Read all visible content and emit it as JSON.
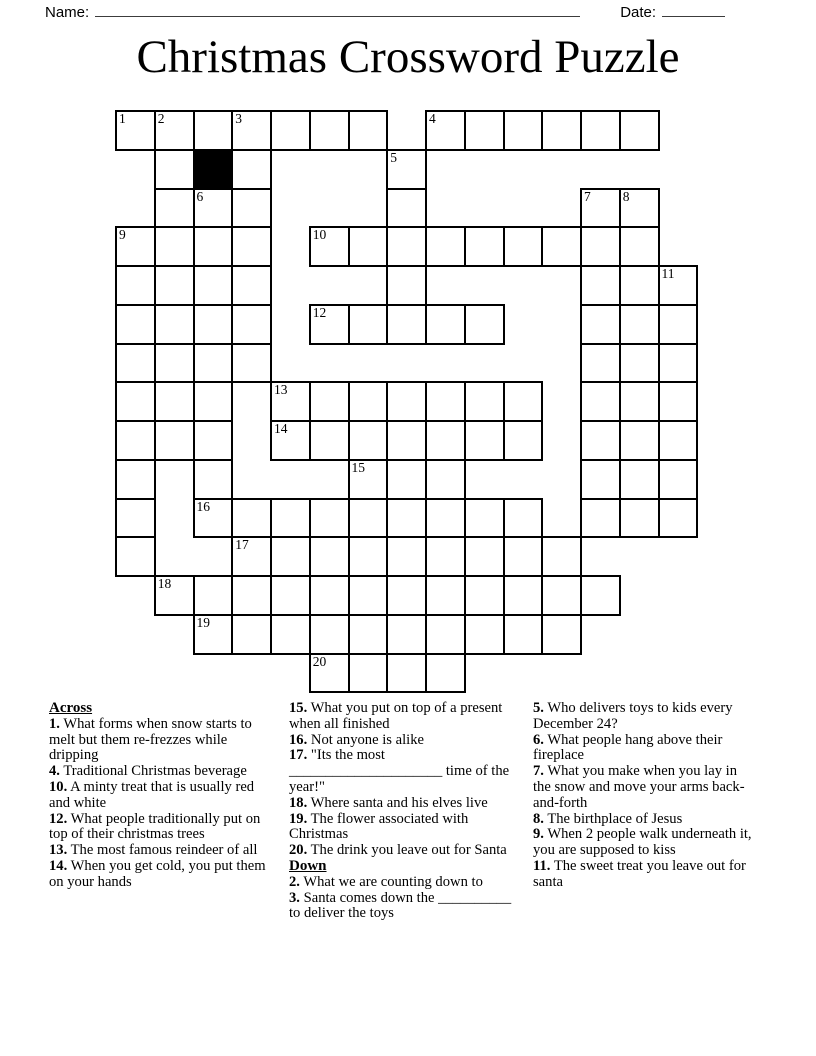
{
  "header": {
    "name_label": "Name:",
    "date_label": "Date:"
  },
  "title": "Christmas Crossword Puzzle",
  "grid": {
    "origin_x": 115,
    "origin_y": 110,
    "cell_size": 38.75,
    "rows": 15,
    "cols": 15,
    "border_color": "#000000",
    "block_color": "#000000",
    "cells": [
      {
        "r": 0,
        "c": 0,
        "n": "1"
      },
      {
        "r": 0,
        "c": 1,
        "n": "2"
      },
      {
        "r": 0,
        "c": 2
      },
      {
        "r": 0,
        "c": 3,
        "n": "3"
      },
      {
        "r": 0,
        "c": 4
      },
      {
        "r": 0,
        "c": 5
      },
      {
        "r": 0,
        "c": 6
      },
      {
        "r": 0,
        "c": 8,
        "n": "4"
      },
      {
        "r": 0,
        "c": 9
      },
      {
        "r": 0,
        "c": 10
      },
      {
        "r": 0,
        "c": 11
      },
      {
        "r": 0,
        "c": 12
      },
      {
        "r": 0,
        "c": 13
      },
      {
        "r": 1,
        "c": 1
      },
      {
        "r": 1,
        "c": 2,
        "b": true
      },
      {
        "r": 1,
        "c": 3
      },
      {
        "r": 1,
        "c": 7,
        "n": "5"
      },
      {
        "r": 2,
        "c": 1
      },
      {
        "r": 2,
        "c": 2,
        "n": "6"
      },
      {
        "r": 2,
        "c": 3
      },
      {
        "r": 2,
        "c": 7
      },
      {
        "r": 2,
        "c": 12,
        "n": "7"
      },
      {
        "r": 2,
        "c": 13,
        "n": "8"
      },
      {
        "r": 3,
        "c": 0,
        "n": "9"
      },
      {
        "r": 3,
        "c": 1
      },
      {
        "r": 3,
        "c": 2
      },
      {
        "r": 3,
        "c": 3
      },
      {
        "r": 3,
        "c": 5,
        "n": "10"
      },
      {
        "r": 3,
        "c": 6
      },
      {
        "r": 3,
        "c": 7
      },
      {
        "r": 3,
        "c": 8
      },
      {
        "r": 3,
        "c": 9
      },
      {
        "r": 3,
        "c": 10
      },
      {
        "r": 3,
        "c": 11
      },
      {
        "r": 3,
        "c": 12
      },
      {
        "r": 3,
        "c": 13
      },
      {
        "r": 4,
        "c": 0
      },
      {
        "r": 4,
        "c": 1
      },
      {
        "r": 4,
        "c": 2
      },
      {
        "r": 4,
        "c": 3
      },
      {
        "r": 4,
        "c": 7
      },
      {
        "r": 4,
        "c": 12
      },
      {
        "r": 4,
        "c": 13
      },
      {
        "r": 4,
        "c": 14,
        "n": "11"
      },
      {
        "r": 5,
        "c": 0
      },
      {
        "r": 5,
        "c": 1
      },
      {
        "r": 5,
        "c": 2
      },
      {
        "r": 5,
        "c": 3
      },
      {
        "r": 5,
        "c": 5,
        "n": "12"
      },
      {
        "r": 5,
        "c": 6
      },
      {
        "r": 5,
        "c": 7
      },
      {
        "r": 5,
        "c": 8
      },
      {
        "r": 5,
        "c": 9
      },
      {
        "r": 5,
        "c": 12
      },
      {
        "r": 5,
        "c": 13
      },
      {
        "r": 5,
        "c": 14
      },
      {
        "r": 6,
        "c": 0
      },
      {
        "r": 6,
        "c": 1
      },
      {
        "r": 6,
        "c": 2
      },
      {
        "r": 6,
        "c": 3
      },
      {
        "r": 6,
        "c": 12
      },
      {
        "r": 6,
        "c": 13
      },
      {
        "r": 6,
        "c": 14
      },
      {
        "r": 7,
        "c": 0
      },
      {
        "r": 7,
        "c": 1
      },
      {
        "r": 7,
        "c": 2
      },
      {
        "r": 7,
        "c": 4,
        "n": "13"
      },
      {
        "r": 7,
        "c": 5
      },
      {
        "r": 7,
        "c": 6
      },
      {
        "r": 7,
        "c": 7
      },
      {
        "r": 7,
        "c": 8
      },
      {
        "r": 7,
        "c": 9
      },
      {
        "r": 7,
        "c": 10
      },
      {
        "r": 7,
        "c": 12
      },
      {
        "r": 7,
        "c": 13
      },
      {
        "r": 7,
        "c": 14
      },
      {
        "r": 8,
        "c": 0
      },
      {
        "r": 8,
        "c": 1
      },
      {
        "r": 8,
        "c": 2
      },
      {
        "r": 8,
        "c": 4,
        "n": "14"
      },
      {
        "r": 8,
        "c": 5
      },
      {
        "r": 8,
        "c": 6
      },
      {
        "r": 8,
        "c": 7
      },
      {
        "r": 8,
        "c": 8
      },
      {
        "r": 8,
        "c": 9
      },
      {
        "r": 8,
        "c": 10
      },
      {
        "r": 8,
        "c": 12
      },
      {
        "r": 8,
        "c": 13
      },
      {
        "r": 8,
        "c": 14
      },
      {
        "r": 9,
        "c": 0
      },
      {
        "r": 9,
        "c": 2
      },
      {
        "r": 9,
        "c": 6,
        "n": "15"
      },
      {
        "r": 9,
        "c": 7
      },
      {
        "r": 9,
        "c": 8
      },
      {
        "r": 9,
        "c": 12
      },
      {
        "r": 9,
        "c": 13
      },
      {
        "r": 9,
        "c": 14
      },
      {
        "r": 10,
        "c": 0
      },
      {
        "r": 10,
        "c": 2,
        "n": "16"
      },
      {
        "r": 10,
        "c": 3
      },
      {
        "r": 10,
        "c": 4
      },
      {
        "r": 10,
        "c": 5
      },
      {
        "r": 10,
        "c": 6
      },
      {
        "r": 10,
        "c": 7
      },
      {
        "r": 10,
        "c": 8
      },
      {
        "r": 10,
        "c": 9
      },
      {
        "r": 10,
        "c": 10
      },
      {
        "r": 10,
        "c": 12
      },
      {
        "r": 10,
        "c": 13
      },
      {
        "r": 10,
        "c": 14
      },
      {
        "r": 11,
        "c": 0
      },
      {
        "r": 11,
        "c": 3,
        "n": "17"
      },
      {
        "r": 11,
        "c": 4
      },
      {
        "r": 11,
        "c": 5
      },
      {
        "r": 11,
        "c": 6
      },
      {
        "r": 11,
        "c": 7
      },
      {
        "r": 11,
        "c": 8
      },
      {
        "r": 11,
        "c": 9
      },
      {
        "r": 11,
        "c": 10
      },
      {
        "r": 11,
        "c": 11
      },
      {
        "r": 12,
        "c": 1,
        "n": "18"
      },
      {
        "r": 12,
        "c": 2
      },
      {
        "r": 12,
        "c": 3
      },
      {
        "r": 12,
        "c": 4
      },
      {
        "r": 12,
        "c": 5
      },
      {
        "r": 12,
        "c": 6
      },
      {
        "r": 12,
        "c": 7
      },
      {
        "r": 12,
        "c": 8
      },
      {
        "r": 12,
        "c": 9
      },
      {
        "r": 12,
        "c": 10
      },
      {
        "r": 12,
        "c": 11
      },
      {
        "r": 12,
        "c": 12
      },
      {
        "r": 13,
        "c": 2,
        "n": "19"
      },
      {
        "r": 13,
        "c": 3
      },
      {
        "r": 13,
        "c": 4
      },
      {
        "r": 13,
        "c": 5
      },
      {
        "r": 13,
        "c": 6
      },
      {
        "r": 13,
        "c": 7
      },
      {
        "r": 13,
        "c": 8
      },
      {
        "r": 13,
        "c": 9
      },
      {
        "r": 13,
        "c": 10
      },
      {
        "r": 13,
        "c": 11
      },
      {
        "r": 14,
        "c": 5,
        "n": "20"
      },
      {
        "r": 14,
        "c": 6
      },
      {
        "r": 14,
        "c": 7
      },
      {
        "r": 14,
        "c": 8
      }
    ]
  },
  "clues": {
    "across_heading": "Across",
    "down_heading": "Down",
    "across": [
      {
        "num": "1.",
        "text": "What forms when snow starts to melt but them re-frezzes while dripping"
      },
      {
        "num": "4.",
        "text": "Traditional Christmas beverage"
      },
      {
        "num": "10.",
        "text": "A minty treat that is usually red and white"
      },
      {
        "num": "12.",
        "text": "What people traditionally put on top of their christmas trees"
      },
      {
        "num": "13.",
        "text": "The most famous reindeer of all"
      },
      {
        "num": "14.",
        "text": "When you get cold, you put them on your hands"
      },
      {
        "num": "15.",
        "text": "What you put on top of a present when all finished"
      },
      {
        "num": "16.",
        "text": "Not anyone is alike"
      },
      {
        "num": "17.",
        "text": "\"Its the most _____________________ time of the year!\""
      },
      {
        "num": "18.",
        "text": "Where santa and his elves live"
      },
      {
        "num": "19.",
        "text": "The flower associated with Christmas"
      },
      {
        "num": "20.",
        "text": "The drink you leave out for Santa"
      }
    ],
    "down": [
      {
        "num": "2.",
        "text": "What we are counting down to"
      },
      {
        "num": "3.",
        "text": "Santa comes down the __________ to deliver the toys"
      },
      {
        "num": "5.",
        "text": "Who delivers toys to kids every December 24?"
      },
      {
        "num": "6.",
        "text": "What people hang above their fireplace"
      },
      {
        "num": "7.",
        "text": "What you make when you lay in the snow and move your arms back-and-forth"
      },
      {
        "num": "8.",
        "text": "The birthplace of Jesus"
      },
      {
        "num": "9.",
        "text": "When 2 people walk underneath it, you are supposed to kiss"
      },
      {
        "num": "11.",
        "text": "The sweet treat you leave out for santa"
      }
    ]
  }
}
